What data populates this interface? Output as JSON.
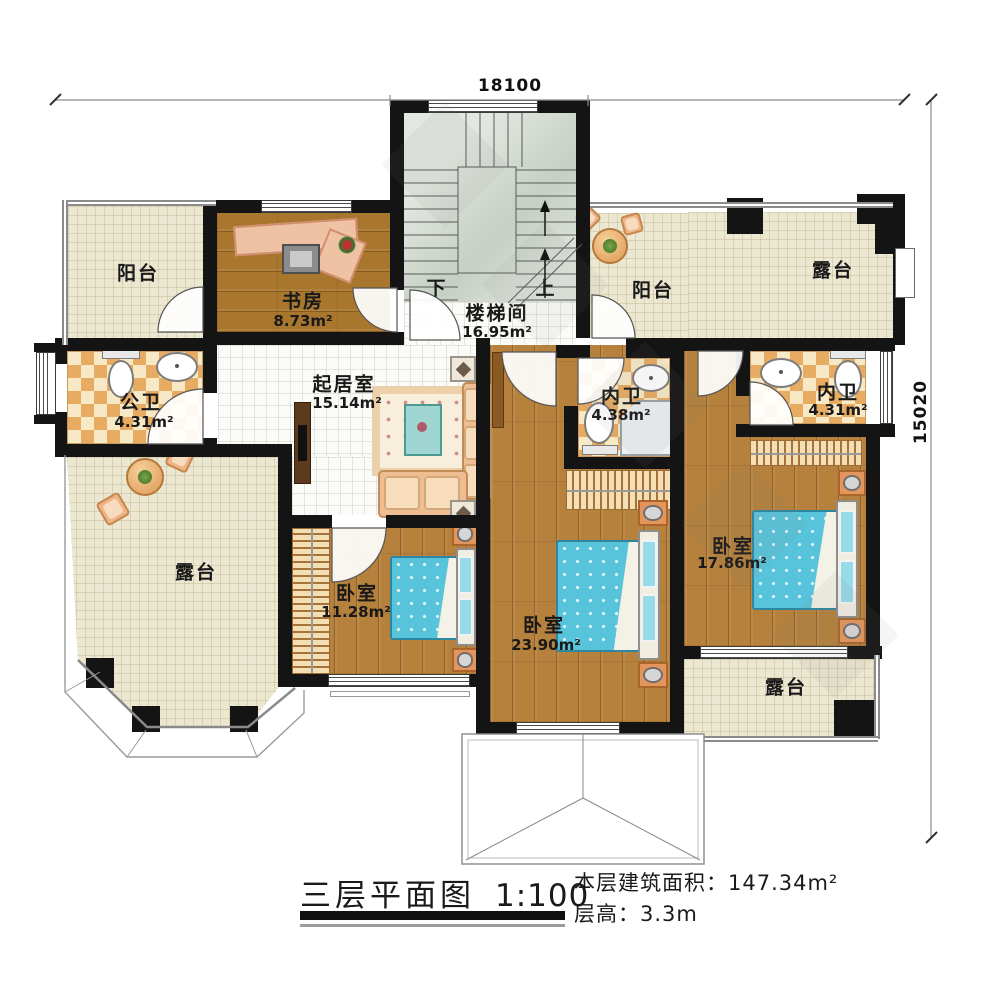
{
  "dims": {
    "top": "18100",
    "right": "15020"
  },
  "rooms": {
    "balcony_tl": {
      "name": "阳台"
    },
    "study": {
      "name": "书房",
      "area": "8.73m²"
    },
    "stair": {
      "name": "楼梯间",
      "area": "16.95m²",
      "down": "下",
      "up": "上"
    },
    "balcony_top": {
      "name": "阳台"
    },
    "terrace_tr": {
      "name": "露台"
    },
    "bath_public": {
      "name": "公卫",
      "area": "4.31m²"
    },
    "living": {
      "name": "起居室",
      "area": "15.14m²"
    },
    "bath_mid": {
      "name": "内卫",
      "area": "4.38m²"
    },
    "bath_right": {
      "name": "内卫",
      "area": "4.31m²"
    },
    "terrace_left": {
      "name": "露台"
    },
    "bedroom_sw": {
      "name": "卧室",
      "area": "11.28m²"
    },
    "bedroom_s": {
      "name": "卧室",
      "area": "23.90m²"
    },
    "bedroom_e": {
      "name": "卧室",
      "area": "17.86m²"
    },
    "terrace_br": {
      "name": "露台"
    }
  },
  "footer": {
    "title": "三层平面图",
    "scale": "1:100",
    "area_label": "本层建筑面积：",
    "area_value": "147.34m²",
    "height_label": "层高：",
    "height_value": "3.3m"
  },
  "colors": {
    "wall": "#141414",
    "wood": "#b5813c",
    "terrace": "#ece7d1",
    "checker_dark": "#e7ab61",
    "checker_light": "#f7e9c6",
    "bed": "#58c4db",
    "stair": "#d2dacf"
  }
}
